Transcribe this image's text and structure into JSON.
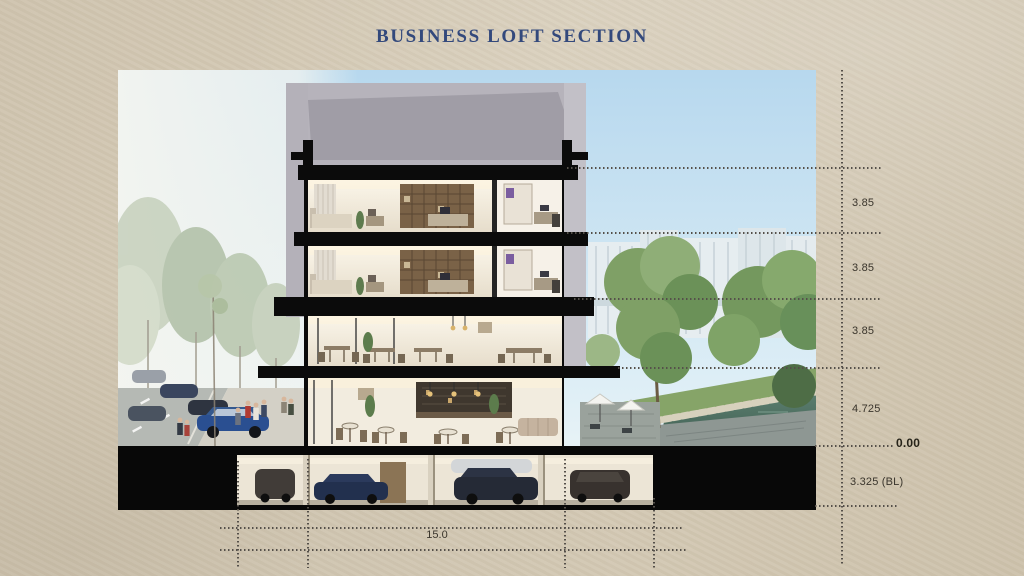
{
  "slide": {
    "title": "BUSINESS LOFT SECTION"
  },
  "annotations": {
    "levels": [
      {
        "value": "3.85"
      },
      {
        "value": "3.85"
      },
      {
        "value": "3.85"
      },
      {
        "value": "4.725"
      },
      {
        "value": "0.00"
      },
      {
        "value": "3.325 (BL)"
      }
    ],
    "width": {
      "value": "15.0"
    }
  },
  "colors": {
    "background_paper": "#d1c6b2",
    "title_navy": "#33497c",
    "dimension_dots": "#55504a",
    "dimension_text": "#3a352c",
    "section_cut_black": "#0b0b0b"
  }
}
